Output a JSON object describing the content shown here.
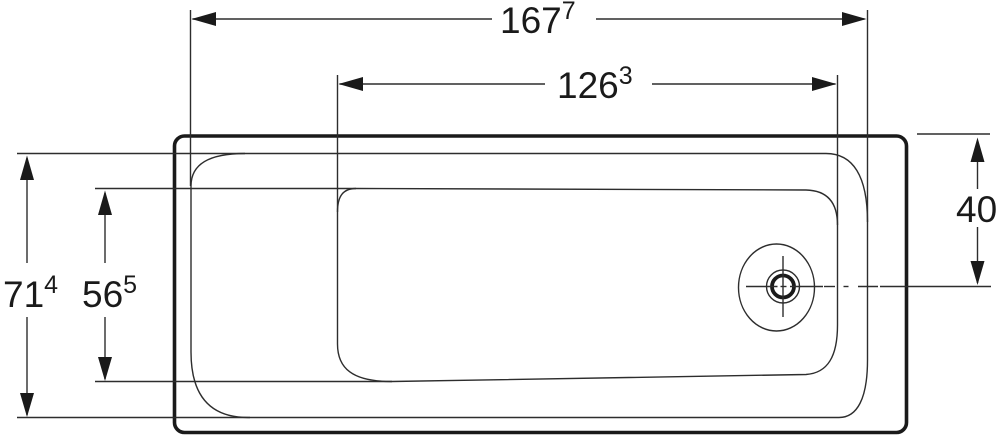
{
  "drawing": {
    "name": "bathtub-top-view-dimension-drawing",
    "colors": {
      "background": "#ffffff",
      "line": "#2d2d2d",
      "thick_line": "#1a1a1a",
      "text": "#1a1a1a"
    },
    "dimensions": {
      "length_outer": {
        "value": "167",
        "sup": "7"
      },
      "length_inner": {
        "value": "126",
        "sup": "3"
      },
      "width_outer": {
        "value": "71",
        "sup": "4"
      },
      "width_inner": {
        "value": "56",
        "sup": "5"
      },
      "drain_offset": {
        "value": "40",
        "sup": ""
      }
    }
  }
}
